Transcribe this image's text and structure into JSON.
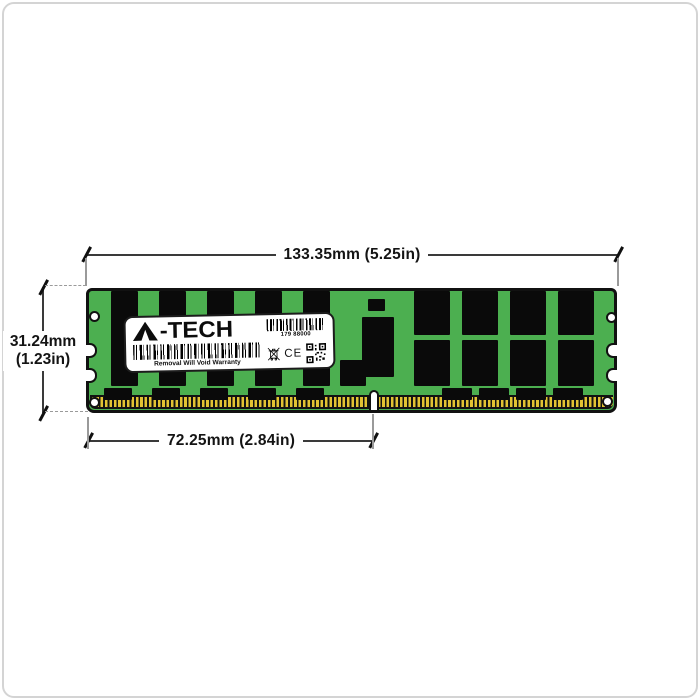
{
  "annotations": {
    "top": {
      "text": "133.35mm (5.25in)"
    },
    "left": {
      "line1": "31.24mm",
      "line2": "(1.23in)"
    },
    "bottom": {
      "text": "72.25mm (2.84in)"
    }
  },
  "label": {
    "brand": "A-TECH",
    "brand_text": "-TECH",
    "serial": "179 88000",
    "warranty": "Removal Will Void Warranty",
    "ce_text": "CE"
  },
  "colors": {
    "pcb_green": "#4caf50",
    "chip_black": "#0a0a0a",
    "pin_gold": "#e2c233",
    "pin_base": "#121212",
    "dim_line": "#3a3a3a",
    "ext_line": "#9a9a9a",
    "label_bg": "#ffffff",
    "outline": "#111111",
    "page_border": "#d4d4d4"
  },
  "module": {
    "chips": [
      [
        22,
        0,
        27,
        95
      ],
      [
        70,
        0,
        27,
        95
      ],
      [
        118,
        0,
        27,
        95
      ],
      [
        166,
        0,
        27,
        95
      ],
      [
        214,
        0,
        27,
        95
      ],
      [
        251,
        69,
        26,
        26
      ],
      [
        15,
        97,
        28,
        12
      ],
      [
        63,
        97,
        28,
        12
      ],
      [
        111,
        97,
        28,
        12
      ],
      [
        159,
        97,
        28,
        12
      ],
      [
        207,
        97,
        28,
        12
      ],
      [
        279,
        8,
        17,
        12
      ],
      [
        273,
        26,
        32,
        60
      ],
      [
        325,
        0,
        36,
        44
      ],
      [
        373,
        0,
        36,
        44
      ],
      [
        421,
        0,
        36,
        44
      ],
      [
        469,
        0,
        36,
        44
      ],
      [
        325,
        49,
        36,
        46
      ],
      [
        373,
        49,
        36,
        46
      ],
      [
        421,
        49,
        36,
        46
      ],
      [
        469,
        49,
        36,
        46
      ],
      [
        353,
        97,
        30,
        12
      ],
      [
        390,
        97,
        30,
        12
      ],
      [
        427,
        97,
        30,
        12
      ],
      [
        464,
        97,
        30,
        12
      ]
    ],
    "holes": [
      [
        0,
        20
      ],
      [
        0,
        106
      ],
      [
        517,
        21
      ],
      [
        513,
        105
      ]
    ],
    "notches_left": [
      52,
      77
    ],
    "notches_right": [
      52,
      77
    ]
  }
}
